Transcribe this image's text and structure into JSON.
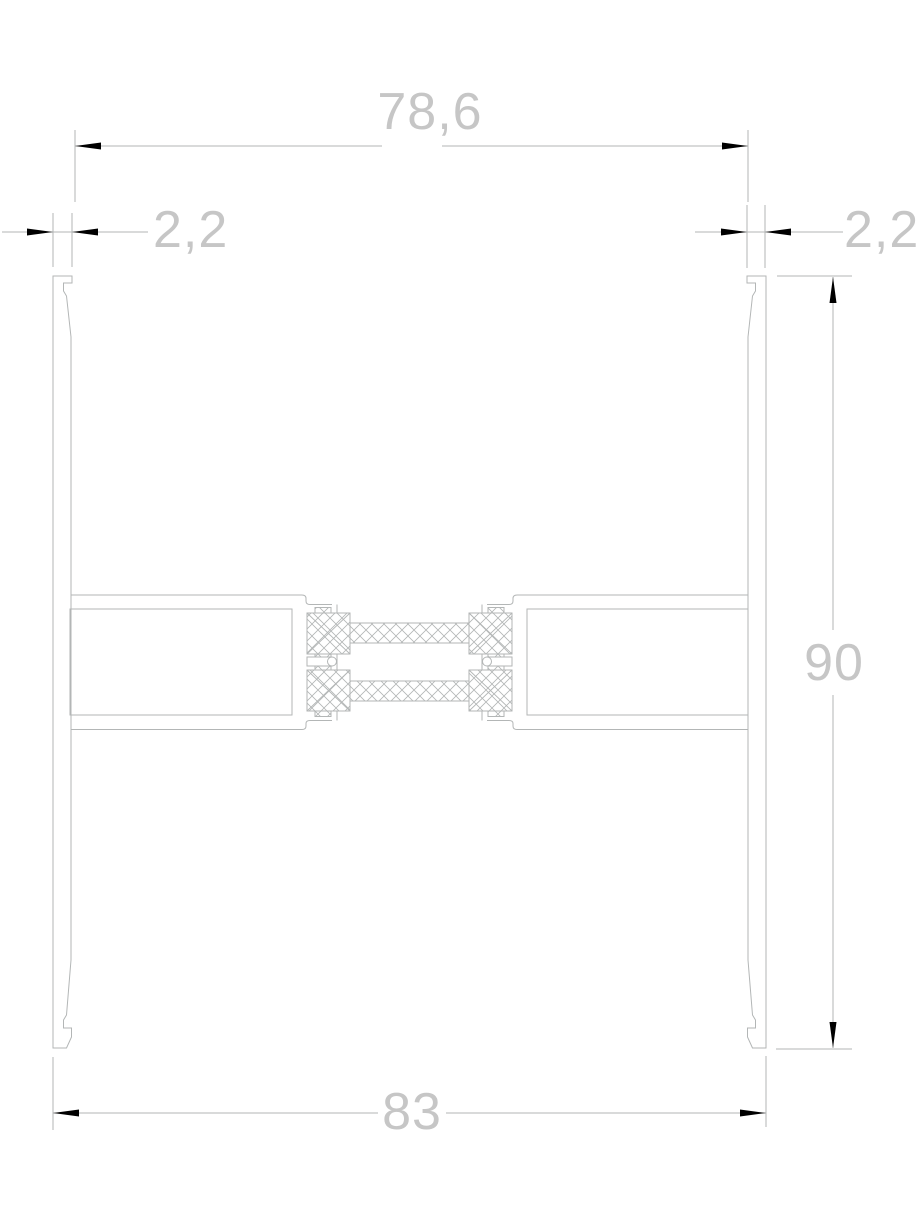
{
  "drawing": {
    "title": "Aluminium thermal-break profile cross-section",
    "type": "CAD dimensioned section drawing",
    "dimensions": {
      "top_width": {
        "label": "78,6",
        "meaning": "inner width between walls (mm)"
      },
      "left_wall_thickness": {
        "label": "2,2",
        "meaning": "left wall thickness (mm)"
      },
      "right_wall_thickness": {
        "label": "2,2",
        "meaning": "right wall thickness (mm)"
      },
      "overall_height": {
        "label": "90",
        "meaning": "overall profile height (mm)"
      },
      "bottom_width": {
        "label": "83",
        "meaning": "overall outer width (mm)"
      }
    },
    "colors": {
      "background": "#ffffff",
      "line": "#b3b6b6",
      "hatch": "#b3b6b6",
      "dimension_text": "#c6c6c6",
      "arrow": "#000000"
    }
  }
}
